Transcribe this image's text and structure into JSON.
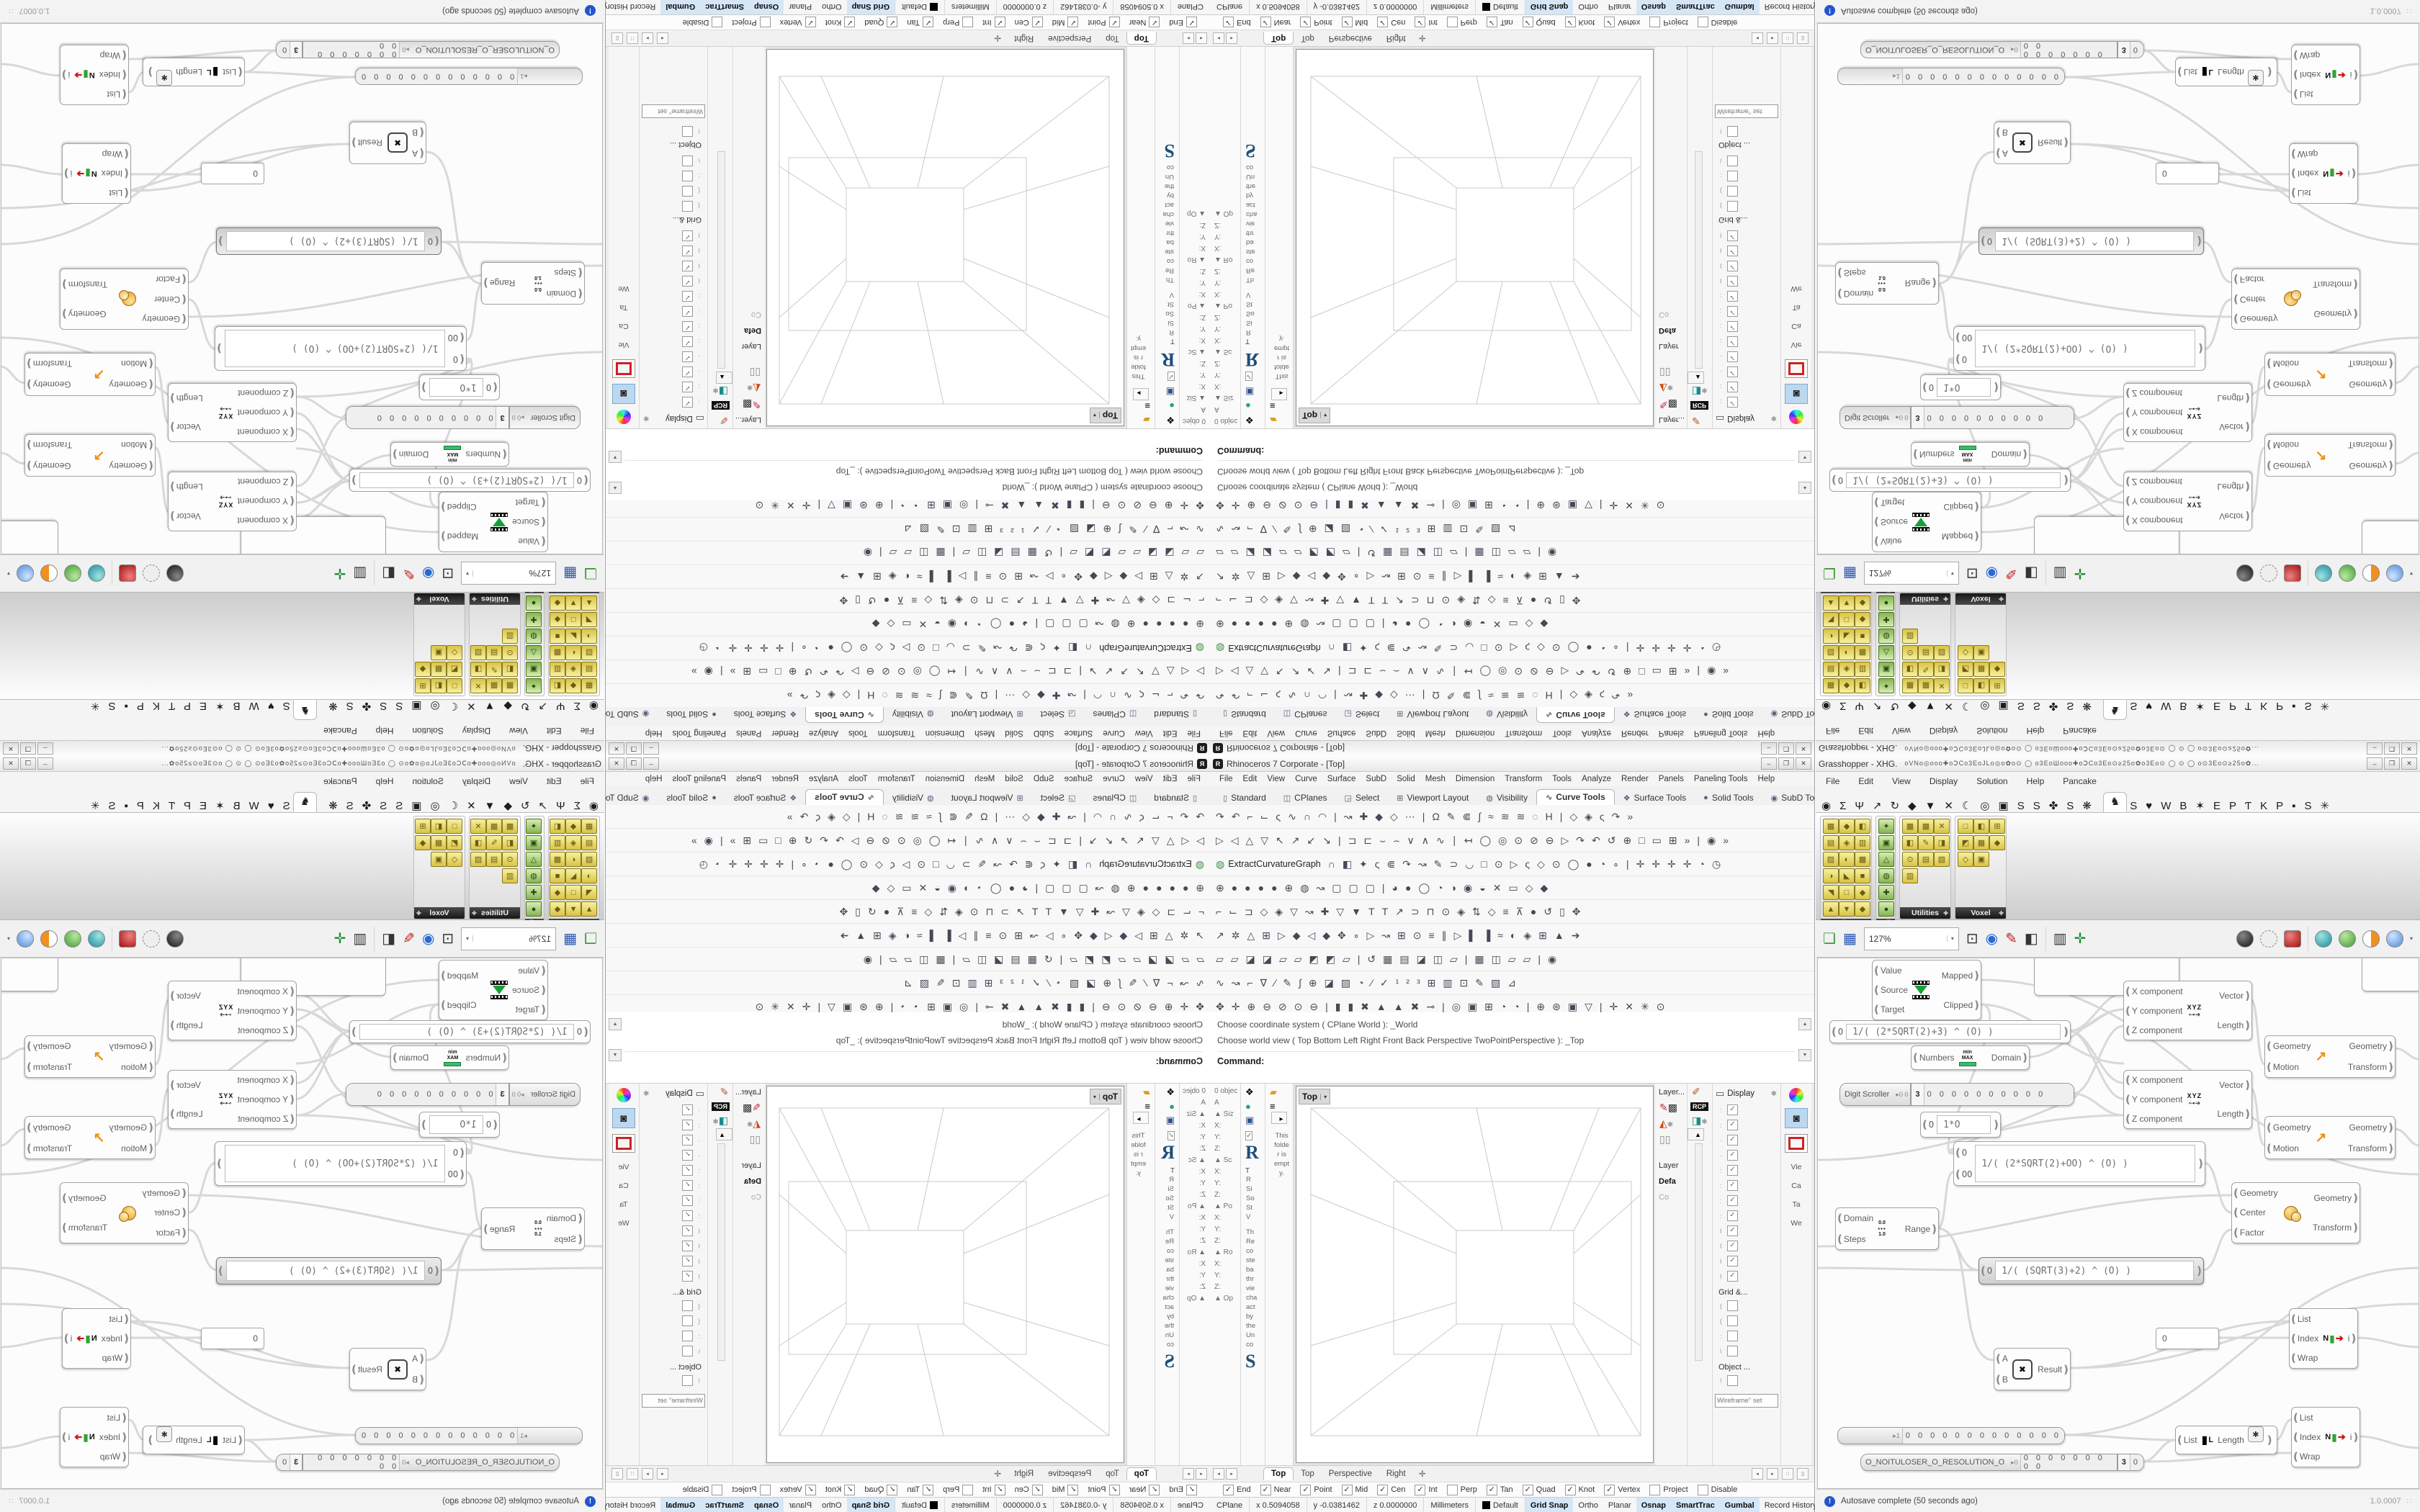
{
  "rhino": {
    "title": "Rhinoceros 7 Corporate - [Top]",
    "app_initial": "R",
    "window_buttons": {
      "min": "–",
      "max": "❒",
      "close": "✕"
    },
    "menu": [
      "File",
      "Edit",
      "View",
      "Curve",
      "Surface",
      "SubD",
      "Solid",
      "Mesh",
      "Dimension",
      "Transform",
      "Tools",
      "Analyze",
      "Render",
      "Panels",
      "Paneling Tools",
      "Help"
    ],
    "tabs": [
      {
        "label": "Standard",
        "icon": "▯",
        "active": "false"
      },
      {
        "label": "CPlanes",
        "icon": "◫",
        "active": "false"
      },
      {
        "label": "Select",
        "icon": "◲",
        "active": "false"
      },
      {
        "label": "Viewport Layout",
        "icon": "⊞",
        "active": "false"
      },
      {
        "label": "Visibility",
        "icon": "◍",
        "active": "false"
      },
      {
        "label": "Curve Tools",
        "icon": "∿",
        "active": "true"
      },
      {
        "label": "Surface Tools",
        "icon": "❖",
        "active": "false"
      },
      {
        "label": "Solid Tools",
        "icon": "●",
        "active": "false"
      },
      {
        "label": "SubD Too",
        "icon": "◉",
        "active": "false"
      }
    ],
    "tab_overflow": "» ✱",
    "toolbar_rows": [
      "↷↶⌐⌙ς∿∩◠|↝✚◆◇⋯|Ω✎⋐∫≈≋≋◌Η|◇◈ς↷»",
      "▷◁△▽↖↗↙↘|⊐⊏⌣⌢∨∧∿∣↤◯◎⊙⊘⊖▷↷↶↺⊕□▭⊞»|◉»",
      "∩◧✦ς⋐↷↝✎⊃◡□⊙▷ς◇⊙◯●◔∘|✛✛✛✛◔◷",
      "⊕●●●●⊕◍↝▢▢▢|◕●◯◔◑◉◒✕▭◇◆",
      "⌐⌙⊐◇◈▽↝✚▽▼ΤΤ↗⊃⊓⊙◈⇅◇≡⊼●↺▯✥",
      "↗✲△⊞▷◆◁◆✥∘▷↝⊞⊙≡∥▷▌▐≈◐◈⊞▲➔",
      "▱▱◪◪▱▱◩◩▱|↺▦▤◪◫▱|▦◫▱▱|◉",
      "∿↝⌐∇∕✎∫⊕◪▨◔∕✓¹²³⊞▥⊡✎▧⊿",
      "✥✛⊕⊖⊘⊙⊖|▮▮✖▲▲✖⊸|◎▣⊞◔◔|⊕⊛▣▽|✛✕✳⊙"
    ],
    "extract_row": {
      "icon": "◍",
      "button": "ExtractCurvatureGraph"
    },
    "command_history": [
      "Choose coordinate system ( CPlane  World ): _World",
      "Choose world view ( Top  Bottom  Left  Right  Front  Back  Perspective  TwoPointPerspective ): _Top"
    ],
    "command_prompt": "Command:",
    "panels": {
      "props_rows": [
        "0 objec",
        "A",
        "▲ Siz",
        "X:",
        "Y:",
        "Z:",
        "▲ Sc",
        "X:",
        "Y:",
        "Z:",
        "▲ Po",
        "X:",
        "Y:",
        "Z:",
        "▲ Ro",
        "X:",
        "Y:",
        "Z:",
        "▲ Op"
      ],
      "help": {
        "big": "R",
        "tab": "T",
        "lines": [
          "R",
          "Si",
          "So",
          "St",
          "V"
        ],
        "para": [
          "Th",
          "Re",
          "co",
          "ste",
          "ba",
          "thr",
          "vie",
          "cha",
          "act",
          "by",
          "the",
          "Un",
          "co"
        ],
        "big2": "S"
      },
      "folder_lines": [
        "This",
        "folde",
        "r is",
        "empt",
        "y."
      ],
      "layer": {
        "title": "Layer...",
        "name": "Layer",
        "value": "Defa",
        "co": "Co"
      },
      "rcp": "RCP",
      "display": {
        "title": "Display",
        "checked": [
          {
            "frag": ":",
            "mark": "✓"
          },
          {
            "frag": ":",
            "mark": "✓"
          },
          {
            "frag": "·",
            "mark": "✓"
          },
          {
            "frag": "·",
            "mark": "✓"
          },
          {
            "frag": ":",
            "mark": "✓"
          },
          {
            "frag": ":",
            "mark": "✓"
          },
          {
            "frag": ":",
            "mark": "✓"
          },
          {
            "frag": ":",
            "mark": "✓"
          },
          {
            "frag": "I",
            "mark": "✓"
          },
          {
            "frag": "I",
            "mark": "✓"
          },
          {
            "frag": "I",
            "mark": "✓"
          },
          {
            "frag": "I",
            "mark": "✓"
          }
        ],
        "grid_section": "Grid &...",
        "unchecked": [
          {
            "frag": "(",
            "mark": ""
          },
          {
            "frag": "(",
            "mark": ""
          },
          {
            "frag": ":",
            "mark": ""
          },
          {
            "frag": "\\",
            "mark": ""
          }
        ],
        "object_section": "Object ...",
        "unchecked2": [
          {
            "frag": "!",
            "mark": ""
          }
        ],
        "clip_section": "Clippin...",
        "dropdown": "Wireframe\" set"
      },
      "side_tabs": [
        "Vie",
        "Ca",
        "Ta",
        "We"
      ]
    },
    "viewport": {
      "label": "Top",
      "caret": "▾",
      "tabs": [
        {
          "label": "Top",
          "active": "true"
        },
        {
          "label": "Top",
          "active": "false"
        },
        {
          "label": "Perspective",
          "active": "false"
        },
        {
          "label": "Right",
          "active": "false"
        }
      ],
      "add_tab": "✛"
    },
    "osnap": [
      {
        "label": "End",
        "mark": "✓"
      },
      {
        "label": "Near",
        "mark": "✓"
      },
      {
        "label": "Point",
        "mark": "✓"
      },
      {
        "label": "Mid",
        "mark": "✓"
      },
      {
        "label": "Cen",
        "mark": "✓"
      },
      {
        "label": "Int",
        "mark": "✓"
      },
      {
        "label": "Perp",
        "mark": ""
      },
      {
        "label": "Tan",
        "mark": "✓"
      },
      {
        "label": "Quad",
        "mark": "✓"
      },
      {
        "label": "Knot",
        "mark": "✓"
      },
      {
        "label": "Vertex",
        "mark": "✓"
      },
      {
        "label": "Project",
        "mark": ""
      },
      {
        "label": "Disable",
        "mark": ""
      }
    ],
    "status": {
      "cplane": "CPlane",
      "x": "x 0.5094058",
      "y": "y -0.0381462",
      "z": "z 0.0000000",
      "units": "Millimeters",
      "layer": "Default",
      "toggles": [
        {
          "label": "Grid Snap",
          "on": "true"
        },
        {
          "label": "Ortho",
          "on": "false"
        },
        {
          "label": "Planar",
          "on": "false"
        },
        {
          "label": "Osnap",
          "on": "true"
        },
        {
          "label": "SmartTrac",
          "on": "true"
        },
        {
          "label": "Gumbal",
          "on": "true"
        },
        {
          "label": "Record History",
          "on": "false"
        },
        {
          "label": "Filter",
          "on": "false"
        },
        {
          "label": "A",
          "on": "false"
        }
      ]
    }
  },
  "gh": {
    "title": "Grasshopper - XHG.",
    "title_glyphs": "oVNo◎ooo✚oↃCo3EoJLo◎o✿o⊙      ◯      o3EoШooo✚oↃCo3Eo⊙≥25o✿o3Eo⊙      ◯      ⊙      ◯     o⊙3Eo⊙≥25o✿...",
    "menu": [
      "File",
      "Edit",
      "View",
      "Display",
      "Solution",
      "Help",
      "Pancake"
    ],
    "tabs_left": "◉ΣΨ↗↻◆▼✕☾◎▣SS✤S❋",
    "tab_active": "♞",
    "tabs_right": "S♥WB✶EPƬKP▪S✳",
    "palettes": [
      {
        "label": "Deform",
        "icons": [
          "▦",
          "◆",
          "◧",
          "▤",
          "◈",
          "▥",
          "▨",
          "◐",
          "▩",
          "◑",
          "◣",
          "■",
          "◥",
          "□",
          "◆",
          "▲",
          "▼",
          "◆"
        ]
      },
      {
        "label": "Refi..",
        "icons": [
          "✦",
          "▣",
          "△",
          "◍",
          "✚",
          "●"
        ]
      },
      {
        "label": "Utilities",
        "icons": [
          "▩",
          "▦",
          "✕",
          "◧",
          "✎",
          "◨",
          "⊙",
          "▤",
          "▧",
          "▥"
        ]
      },
      {
        "label": "Voxel",
        "icons": [
          "□",
          "◧",
          "⊞",
          "◩",
          "▦",
          "◆",
          "◇",
          "▣"
        ]
      }
    ],
    "toolbar": {
      "zoom": "127%",
      "caret": "▾"
    },
    "nodes": {
      "remap": {
        "in": [
          "Value",
          "Source",
          "Target"
        ],
        "out": [
          "Mapped",
          "Clipped"
        ]
      },
      "expr1": {
        "in": "O",
        "text": "1/( (2*SQRT(2)+3) ^ (O) )"
      },
      "domain": {
        "in": "Numbers",
        "out": "Domain",
        "ic_top": "min",
        "ic_bot": "MAX"
      },
      "scroller": {
        "label": "Digit Scroller",
        "prefix": "▸0 0",
        "value": "3",
        "digits": "0 0 0 0 0 0 0 0 0 0"
      },
      "vec": {
        "in": [
          "X component",
          "Y component",
          "Z component"
        ],
        "out": [
          "Vector",
          "Length"
        ],
        "icon": "XYZ",
        "arrow": "⊶➔"
      },
      "move": {
        "in": [
          "Geometry",
          "Motion"
        ],
        "out": [
          "Geometry",
          "Transform"
        ],
        "icon": "↗"
      },
      "mul0": {
        "in": "O",
        "text": "1*O"
      },
      "expr2": {
        "in": [
          "O",
          "OO"
        ],
        "text": "1/( (2*SQRT(2)+OO) ^ (O) )"
      },
      "scale": {
        "in": [
          "Geometry",
          "Center",
          "Factor"
        ],
        "out": [
          "Geometry",
          "Transform"
        ]
      },
      "range": {
        "in": [
          "Domain",
          "Steps"
        ],
        "out": "Range",
        "ic_top": "0.0",
        "ic_mid": "▪▪▪",
        "ic_bot": "1.0"
      },
      "exprsel": {
        "in": "O",
        "text": "1/( (SQRT(3)+2) ^ (O) )"
      },
      "panel0": "0",
      "listitem": {
        "in": [
          "List",
          "Index",
          "Wrap"
        ],
        "out": "i",
        "icon": "N",
        "arrow": "➔",
        "bar": "▮"
      },
      "multiply": {
        "in": [
          "A",
          "B"
        ],
        "out": "Result",
        "icon": "✖"
      },
      "slider2": {
        "prefix": "▸1",
        "digits": "0 0 0 0 0 0 0 0 0 0 0 0 0"
      },
      "resslider": {
        "label": "O_NOITULOSER_O_RESOLUTION_O",
        "prefix": "▸0",
        "digits": "0 0 0 0 0 0 0 0 0",
        "value": "3",
        "tail": "0"
      },
      "listlength": {
        "in": "List",
        "out": "Length",
        "icon": "L",
        "extra": "✱"
      }
    },
    "status": {
      "autosave": "Autosave complete (50 seconds ago)",
      "version": "1.0.0007",
      "grip": "∷"
    }
  }
}
